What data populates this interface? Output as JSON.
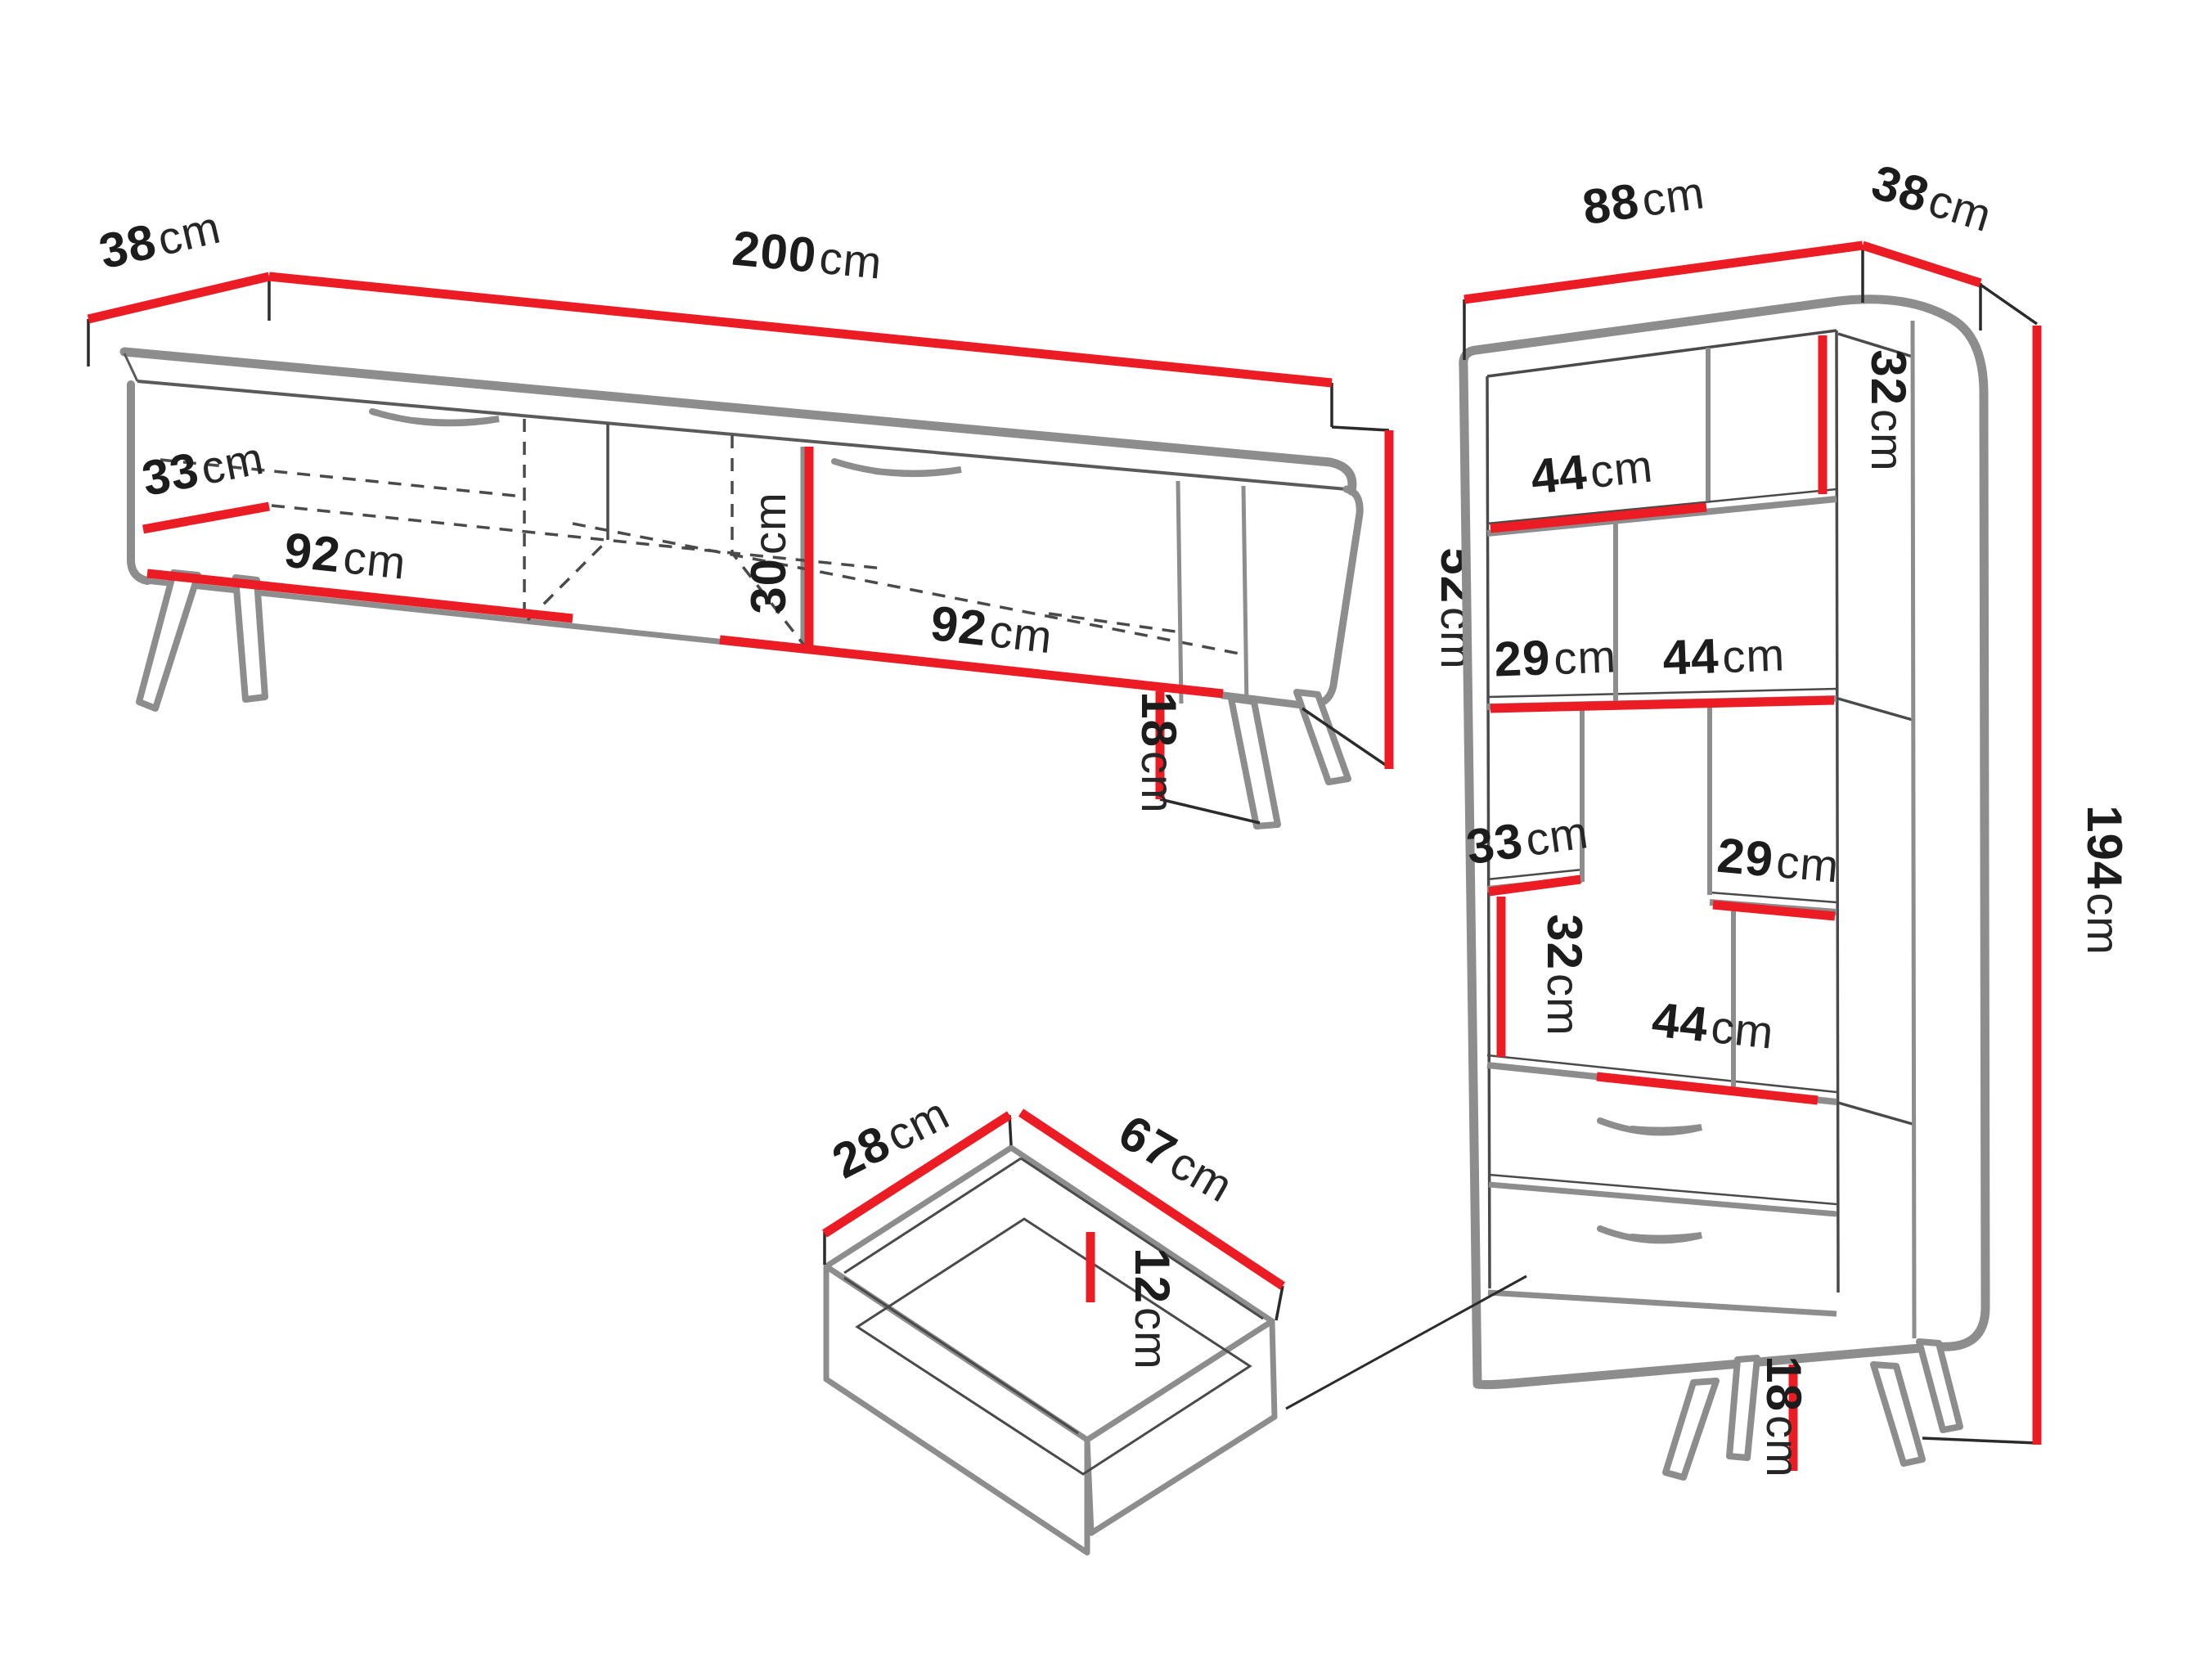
{
  "diagram_title": "furniture-dimension-diagram",
  "colors": {
    "dimension_line": "#ec1c24",
    "furniture_outline_gray": "#8d8d8d",
    "thin_line": "#3c3c3c",
    "label_text": "#1c1c1c",
    "background": "#ffffff"
  },
  "pieces": {
    "tv_stand": {
      "name": "tv-stand",
      "dims": {
        "top_depth": {
          "num": "38",
          "unit": "cm"
        },
        "width": {
          "num": "200",
          "unit": "cm"
        },
        "inner_depth": {
          "num": "33",
          "unit": "cm"
        },
        "left_section": {
          "num": "92",
          "unit": "cm"
        },
        "niche_height": {
          "num": "30",
          "unit": "cm"
        },
        "right_section": {
          "num": "92",
          "unit": "cm"
        },
        "body_height": {
          "num": "52",
          "unit": "cm"
        },
        "leg_height": {
          "num": "18",
          "unit": "cm"
        }
      }
    },
    "bookcase": {
      "name": "bookcase",
      "dims": {
        "width": {
          "num": "88",
          "unit": "cm"
        },
        "top_depth": {
          "num": "38",
          "unit": "cm"
        },
        "top_cell_height": {
          "num": "32",
          "unit": "cm"
        },
        "top_cell_width": {
          "num": "44",
          "unit": "cm"
        },
        "row2_left_width": {
          "num": "29",
          "unit": "cm"
        },
        "row2_right_width": {
          "num": "44",
          "unit": "cm"
        },
        "row3_left_depth": {
          "num": "33",
          "unit": "cm"
        },
        "row3_right_width": {
          "num": "29",
          "unit": "cm"
        },
        "row4_cell_height": {
          "num": "32",
          "unit": "cm"
        },
        "row4_cell_width": {
          "num": "44",
          "unit": "cm"
        },
        "total_height": {
          "num": "194",
          "unit": "cm"
        },
        "leg_height": {
          "num": "18",
          "unit": "cm"
        }
      }
    },
    "drawer": {
      "name": "drawer-inset-detail",
      "dims": {
        "depth": {
          "num": "28",
          "unit": "cm"
        },
        "width": {
          "num": "67",
          "unit": "cm"
        },
        "inner_height": {
          "num": "12",
          "unit": "cm"
        }
      }
    }
  }
}
